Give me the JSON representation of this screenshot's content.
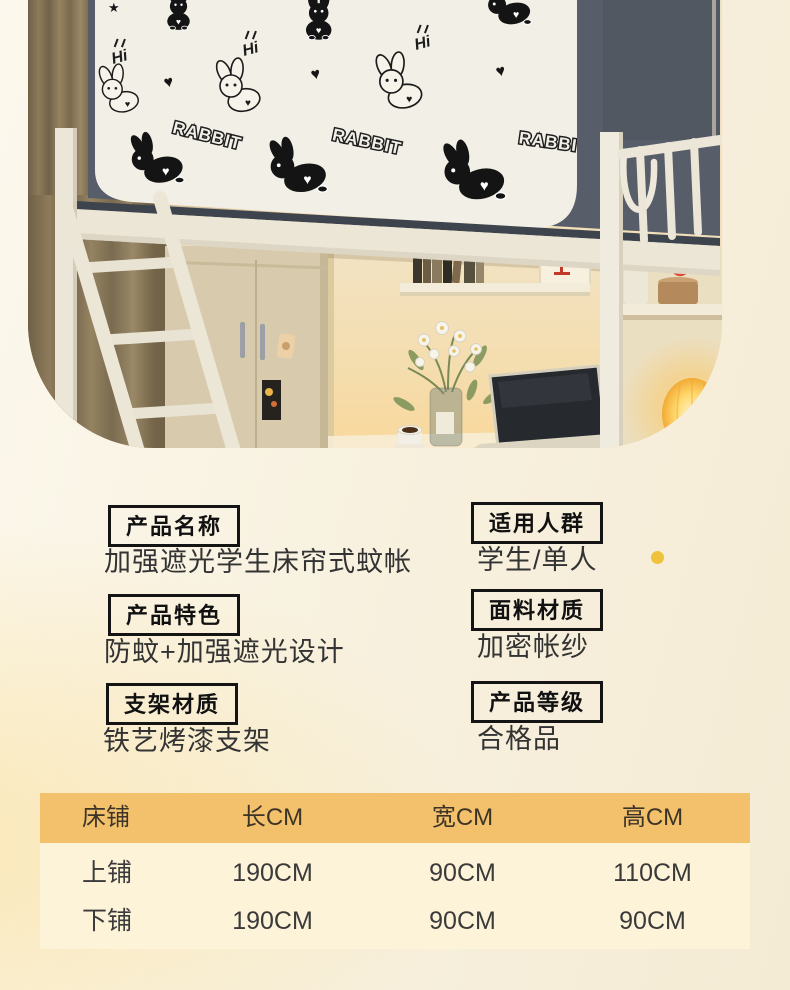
{
  "photo": {
    "description_colors": {
      "canopy_fabric": "#575e69",
      "canopy_panel": "#f2efe6",
      "bed_frame": "#ece6d7",
      "curtain": "#8d7b5a",
      "wardrobe": "#d8cbad",
      "lamp_glow": "#ffd96e",
      "vase_red": "#df4a39"
    },
    "words": {
      "hi": "Hi",
      "rabbit": "RABBIT"
    },
    "icons": {
      "heart": "♥",
      "star": "★"
    }
  },
  "specs": {
    "items": [
      {
        "label": "产品名称",
        "value": "加强遮光学生床帘式蚊帐"
      },
      {
        "label": "适用人群",
        "value": "学生/单人"
      },
      {
        "label": "产品特色",
        "value": "防蚊+加强遮光设计"
      },
      {
        "label": "面料材质",
        "value": "加密帐纱"
      },
      {
        "label": "支架材质",
        "value": "铁艺烤漆支架"
      },
      {
        "label": "产品等级",
        "value": "合格品"
      }
    ],
    "accent_dot_color": "#f0c23c"
  },
  "size_table": {
    "headers": [
      "床铺",
      "长CM",
      "宽CM",
      "高CM"
    ],
    "rows": [
      [
        "上铺",
        "190CM",
        "90CM",
        "110CM"
      ],
      [
        "下铺",
        "190CM",
        "90CM",
        "90CM"
      ]
    ],
    "header_bg": "#f3c06c",
    "body_bg": "#fcf3d8"
  }
}
